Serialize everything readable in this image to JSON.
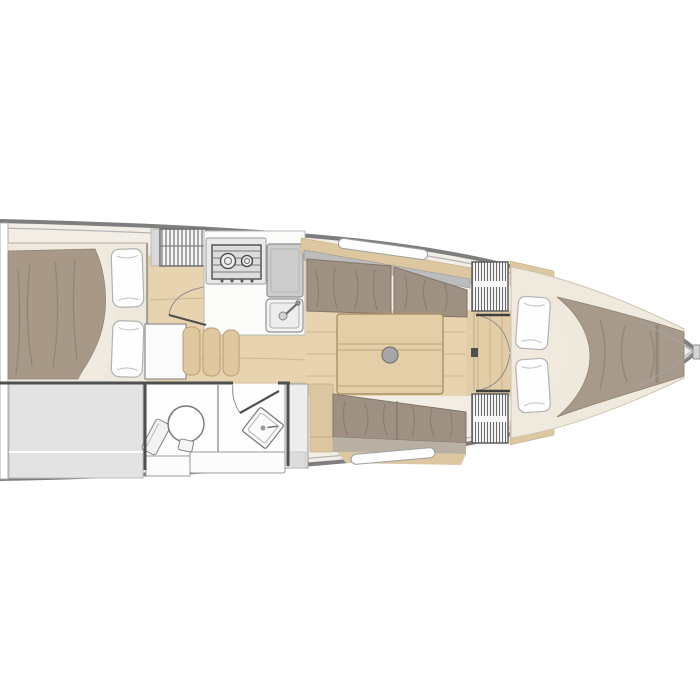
{
  "image": {
    "width": 700,
    "height": 700,
    "background": "#ffffff",
    "kind": "sailboat-interior-floor-plan",
    "orientation": "bow-pointing-right"
  },
  "colors": {
    "deck_cream": "#f3eee5",
    "berth_cream": "#efe8dc",
    "mattress_cream": "#f0e9dd",
    "duvet_taupe": "#a79887",
    "blanket_taupe": "#a89a8b",
    "cushion_taupe": "#9e9082",
    "cushion_light": "#b9b0a4",
    "wood_floor": "#e7d3af",
    "wood_mid": "#e2cda6",
    "wood_trim": "#dcc7a0",
    "wood_slat": "#e0c79e",
    "table_wood": "#e3cea7",
    "gray_storage": "#e3e3e3",
    "gray_cabinet": "#ededed",
    "gray_counter": "#cdcdcd",
    "pillow_white": "#fefefe",
    "floor_white": "#fdfdfd",
    "hull_stroke": "#7e7e7e",
    "wall_dark": "#4f4f4f",
    "table_leg_gray": "#a6a6a6"
  },
  "fixtures": [
    "aft-double-berth",
    "aft-berth-pillows",
    "stern-storage",
    "transom",
    "companionway-steps",
    "sliding-hatch",
    "aft-cabin-door",
    "galley-stove",
    "galley-counter",
    "galley-sink",
    "berth-seat-slats",
    "head-toilet",
    "head-corner-sink",
    "head-door",
    "head-shelves",
    "saloon-table",
    "table-pedestal",
    "port-settee",
    "starboard-settee",
    "hull-windows",
    "bow-bulkhead-lockers",
    "bow-double-doors",
    "v-berth-mattress",
    "v-berth-pillows",
    "v-berth-blanket",
    "bow-fitting"
  ]
}
